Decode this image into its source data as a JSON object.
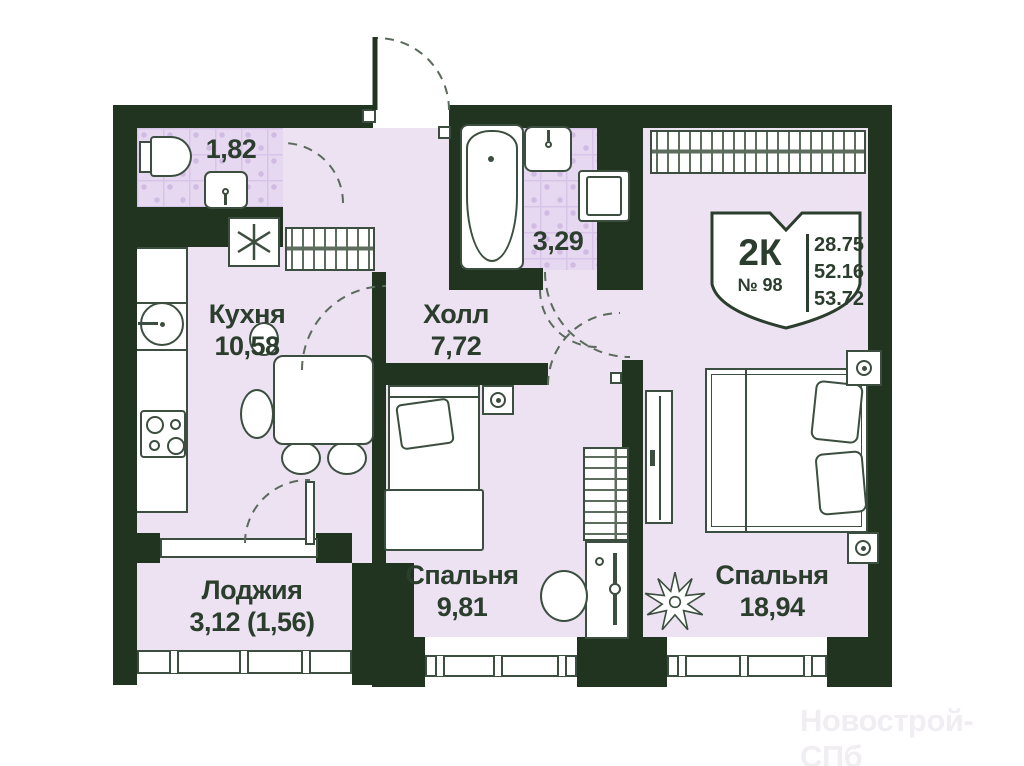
{
  "plan": {
    "watermark": "Новострой-СПб",
    "badge": {
      "unit_type": "2К",
      "unit_number": "№ 98",
      "areas": [
        "28.75",
        "52.16",
        "53.72"
      ]
    },
    "rooms": [
      {
        "id": "bathroom-small",
        "name": "",
        "area": "1,82"
      },
      {
        "id": "kitchen",
        "name": "Кухня",
        "area": "10,58"
      },
      {
        "id": "hall",
        "name": "Холл",
        "area": "7,72"
      },
      {
        "id": "bathroom",
        "name": "",
        "area": "3,29"
      },
      {
        "id": "bedroom-small",
        "name": "Спальня",
        "area": "9,81"
      },
      {
        "id": "bedroom-large",
        "name": "Спальня",
        "area": "18,94"
      },
      {
        "id": "loggia",
        "name": "Лоджия",
        "area": "3,12 (1,56)"
      }
    ],
    "colors": {
      "wall": "#203420",
      "floor": "#ece2f1",
      "tile": "#e6d8f0",
      "outline": "#3c4e3f",
      "text": "#2b3d2c",
      "watermark": "#f0edf3"
    }
  }
}
